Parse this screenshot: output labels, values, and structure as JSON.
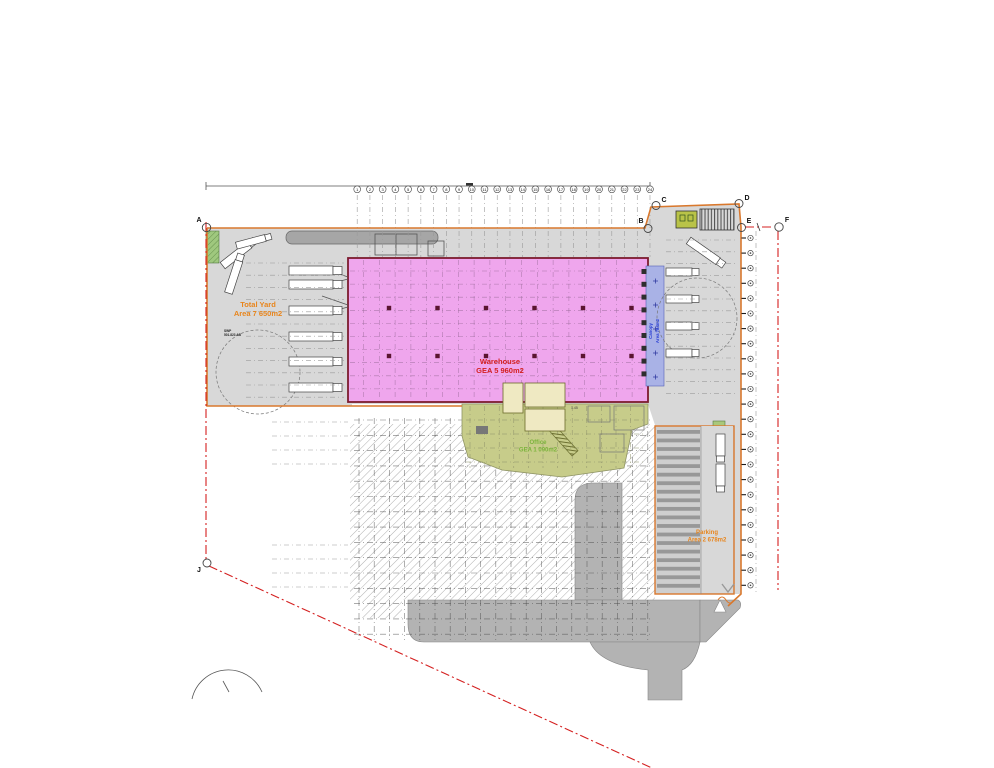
{
  "plan": {
    "title": "Warehouse Site Plan",
    "labels": {
      "total_yard": {
        "line1": "Total Yard",
        "line2": "Area 7 650m2"
      },
      "warehouse": {
        "line1": "Warehouse",
        "line2": "GEA 5 960m2"
      },
      "office": {
        "line1": "Office",
        "line2": "GEA 1 090m2"
      },
      "parking": {
        "line1": "Parking",
        "line2": "Area 2 678m2"
      },
      "canopy": {
        "line1": "Canopy",
        "line2": "Area 784m2"
      },
      "survey_note": {
        "line1": "SWP",
        "line2": "501.823 AB"
      },
      "level_marker": "1.45"
    },
    "boundary_markers": [
      {
        "label": "A"
      },
      {
        "label": "B"
      },
      {
        "label": "C"
      },
      {
        "label": "D"
      },
      {
        "label": "E"
      },
      {
        "label": "F"
      },
      {
        "label": "J"
      }
    ],
    "grid_bubbles": [
      "1",
      "2",
      "3",
      "4",
      "5",
      "6",
      "7",
      "8",
      "9",
      "10",
      "11",
      "12",
      "13",
      "14",
      "15",
      "16",
      "17",
      "18",
      "19",
      "20",
      "21",
      "22",
      "23",
      "24"
    ],
    "edge_marker_count": 24,
    "colors": {
      "warehouse_fill": "#efa6ed",
      "office_fill": "#c7cc8a",
      "canopy_fill": "#a9b2e6",
      "yard_fill": "#d8d8d8",
      "road_fill": "#b3b3b3",
      "boundary_orange": "#d9782d",
      "boundary_red": "#d42020",
      "text_orange": "#e8851c",
      "text_red": "#d42020",
      "text_green": "#7cb43c",
      "text_blue": "#2a3fd4"
    }
  }
}
